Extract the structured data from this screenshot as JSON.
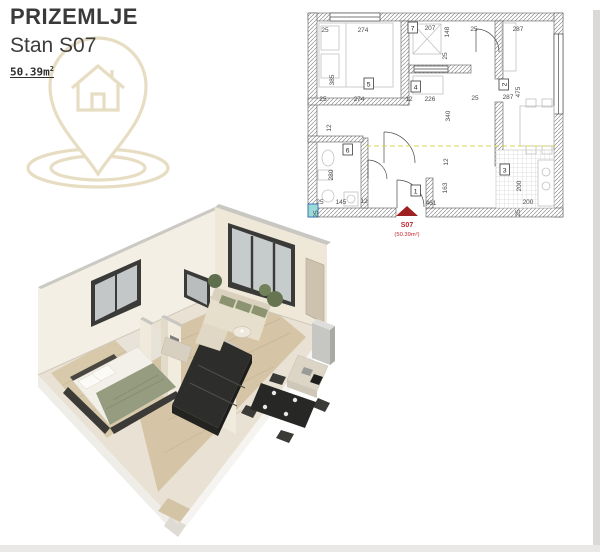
{
  "header": {
    "title": "PRIZEMLJE",
    "subtitle": "Stan S07",
    "area_value": "50.39m",
    "area_sup": "2"
  },
  "plan2d": {
    "unit_label": "S07",
    "unit_area": "(50.39m²)",
    "rooms": [
      {
        "n": "1"
      },
      {
        "n": "2"
      },
      {
        "n": "3"
      },
      {
        "n": "4"
      },
      {
        "n": "5"
      },
      {
        "n": "6"
      },
      {
        "n": "7"
      }
    ],
    "dims": [
      {
        "v": "25"
      },
      {
        "v": "274"
      },
      {
        "v": "207"
      },
      {
        "v": "148"
      },
      {
        "v": "25"
      },
      {
        "v": "287"
      },
      {
        "v": "385"
      },
      {
        "v": "25"
      },
      {
        "v": "25"
      },
      {
        "v": "274"
      },
      {
        "v": "12"
      },
      {
        "v": "226"
      },
      {
        "v": "25"
      },
      {
        "v": "287"
      },
      {
        "v": "475"
      },
      {
        "v": "340"
      },
      {
        "v": "12"
      },
      {
        "v": "280"
      },
      {
        "v": "25"
      },
      {
        "v": "145"
      },
      {
        "v": "12"
      },
      {
        "v": "461"
      },
      {
        "v": "163"
      },
      {
        "v": "12"
      },
      {
        "v": "200"
      },
      {
        "v": "200"
      },
      {
        "v": "25"
      },
      {
        "v": "25"
      }
    ]
  },
  "colors": {
    "accent_red": "#c1272d",
    "watermark_tan": "#e6dcc0",
    "dashed_axis": "#d4d45a",
    "shaft_teal": "#9adbd8",
    "wall_cream": "#f3eee3",
    "floor_wood": "#d5c5a6"
  }
}
